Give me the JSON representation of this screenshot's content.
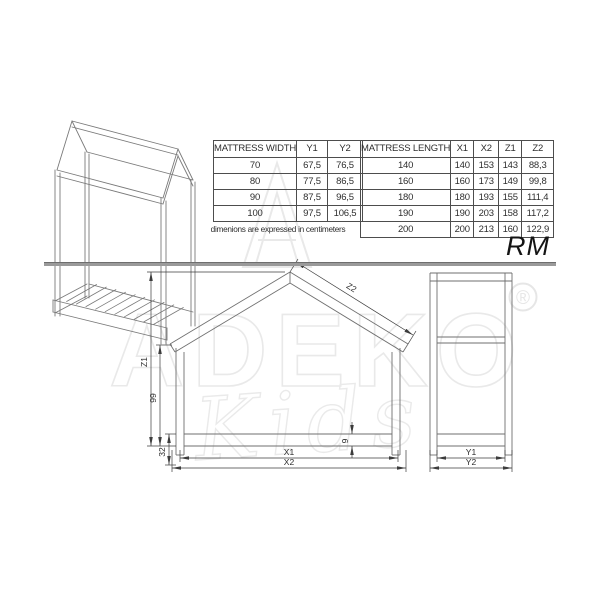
{
  "page": {
    "model_name": "RM",
    "caption": "dimenions are expressed in centimeters"
  },
  "tables": {
    "width": {
      "header": [
        "MATTRESS WIDTH",
        "Y1",
        "Y2"
      ],
      "rows": [
        [
          "70",
          "67,5",
          "76,5"
        ],
        [
          "80",
          "77,5",
          "86,5"
        ],
        [
          "90",
          "87,5",
          "96,5"
        ],
        [
          "100",
          "97,5",
          "106,5"
        ]
      ]
    },
    "length": {
      "header": [
        "MATTRESS LENGTH",
        "X1",
        "X2",
        "Z1",
        "Z2"
      ],
      "rows": [
        [
          "140",
          "140",
          "153",
          "143",
          "88,3"
        ],
        [
          "160",
          "160",
          "173",
          "149",
          "99,8"
        ],
        [
          "180",
          "180",
          "193",
          "155",
          "111,4"
        ],
        [
          "190",
          "190",
          "203",
          "158",
          "117,2"
        ],
        [
          "200",
          "200",
          "213",
          "160",
          "122,9"
        ]
      ]
    }
  },
  "drawing": {
    "labels": {
      "z1": "Z1",
      "z2": "Z2",
      "wall_height": "99",
      "rail_floor": "32",
      "rail_height": "9",
      "x1": "X1",
      "x2": "X2",
      "y1": "Y1",
      "y2": "Y2"
    }
  },
  "watermark": {
    "brand": "ADEKO",
    "sub": "Kids",
    "registered": "®"
  },
  "colors": {
    "drawing_line": "#707070",
    "dimension_line": "#3c3c3c",
    "divider": "#9a9a9a",
    "watermark": "#e9e9e9"
  }
}
